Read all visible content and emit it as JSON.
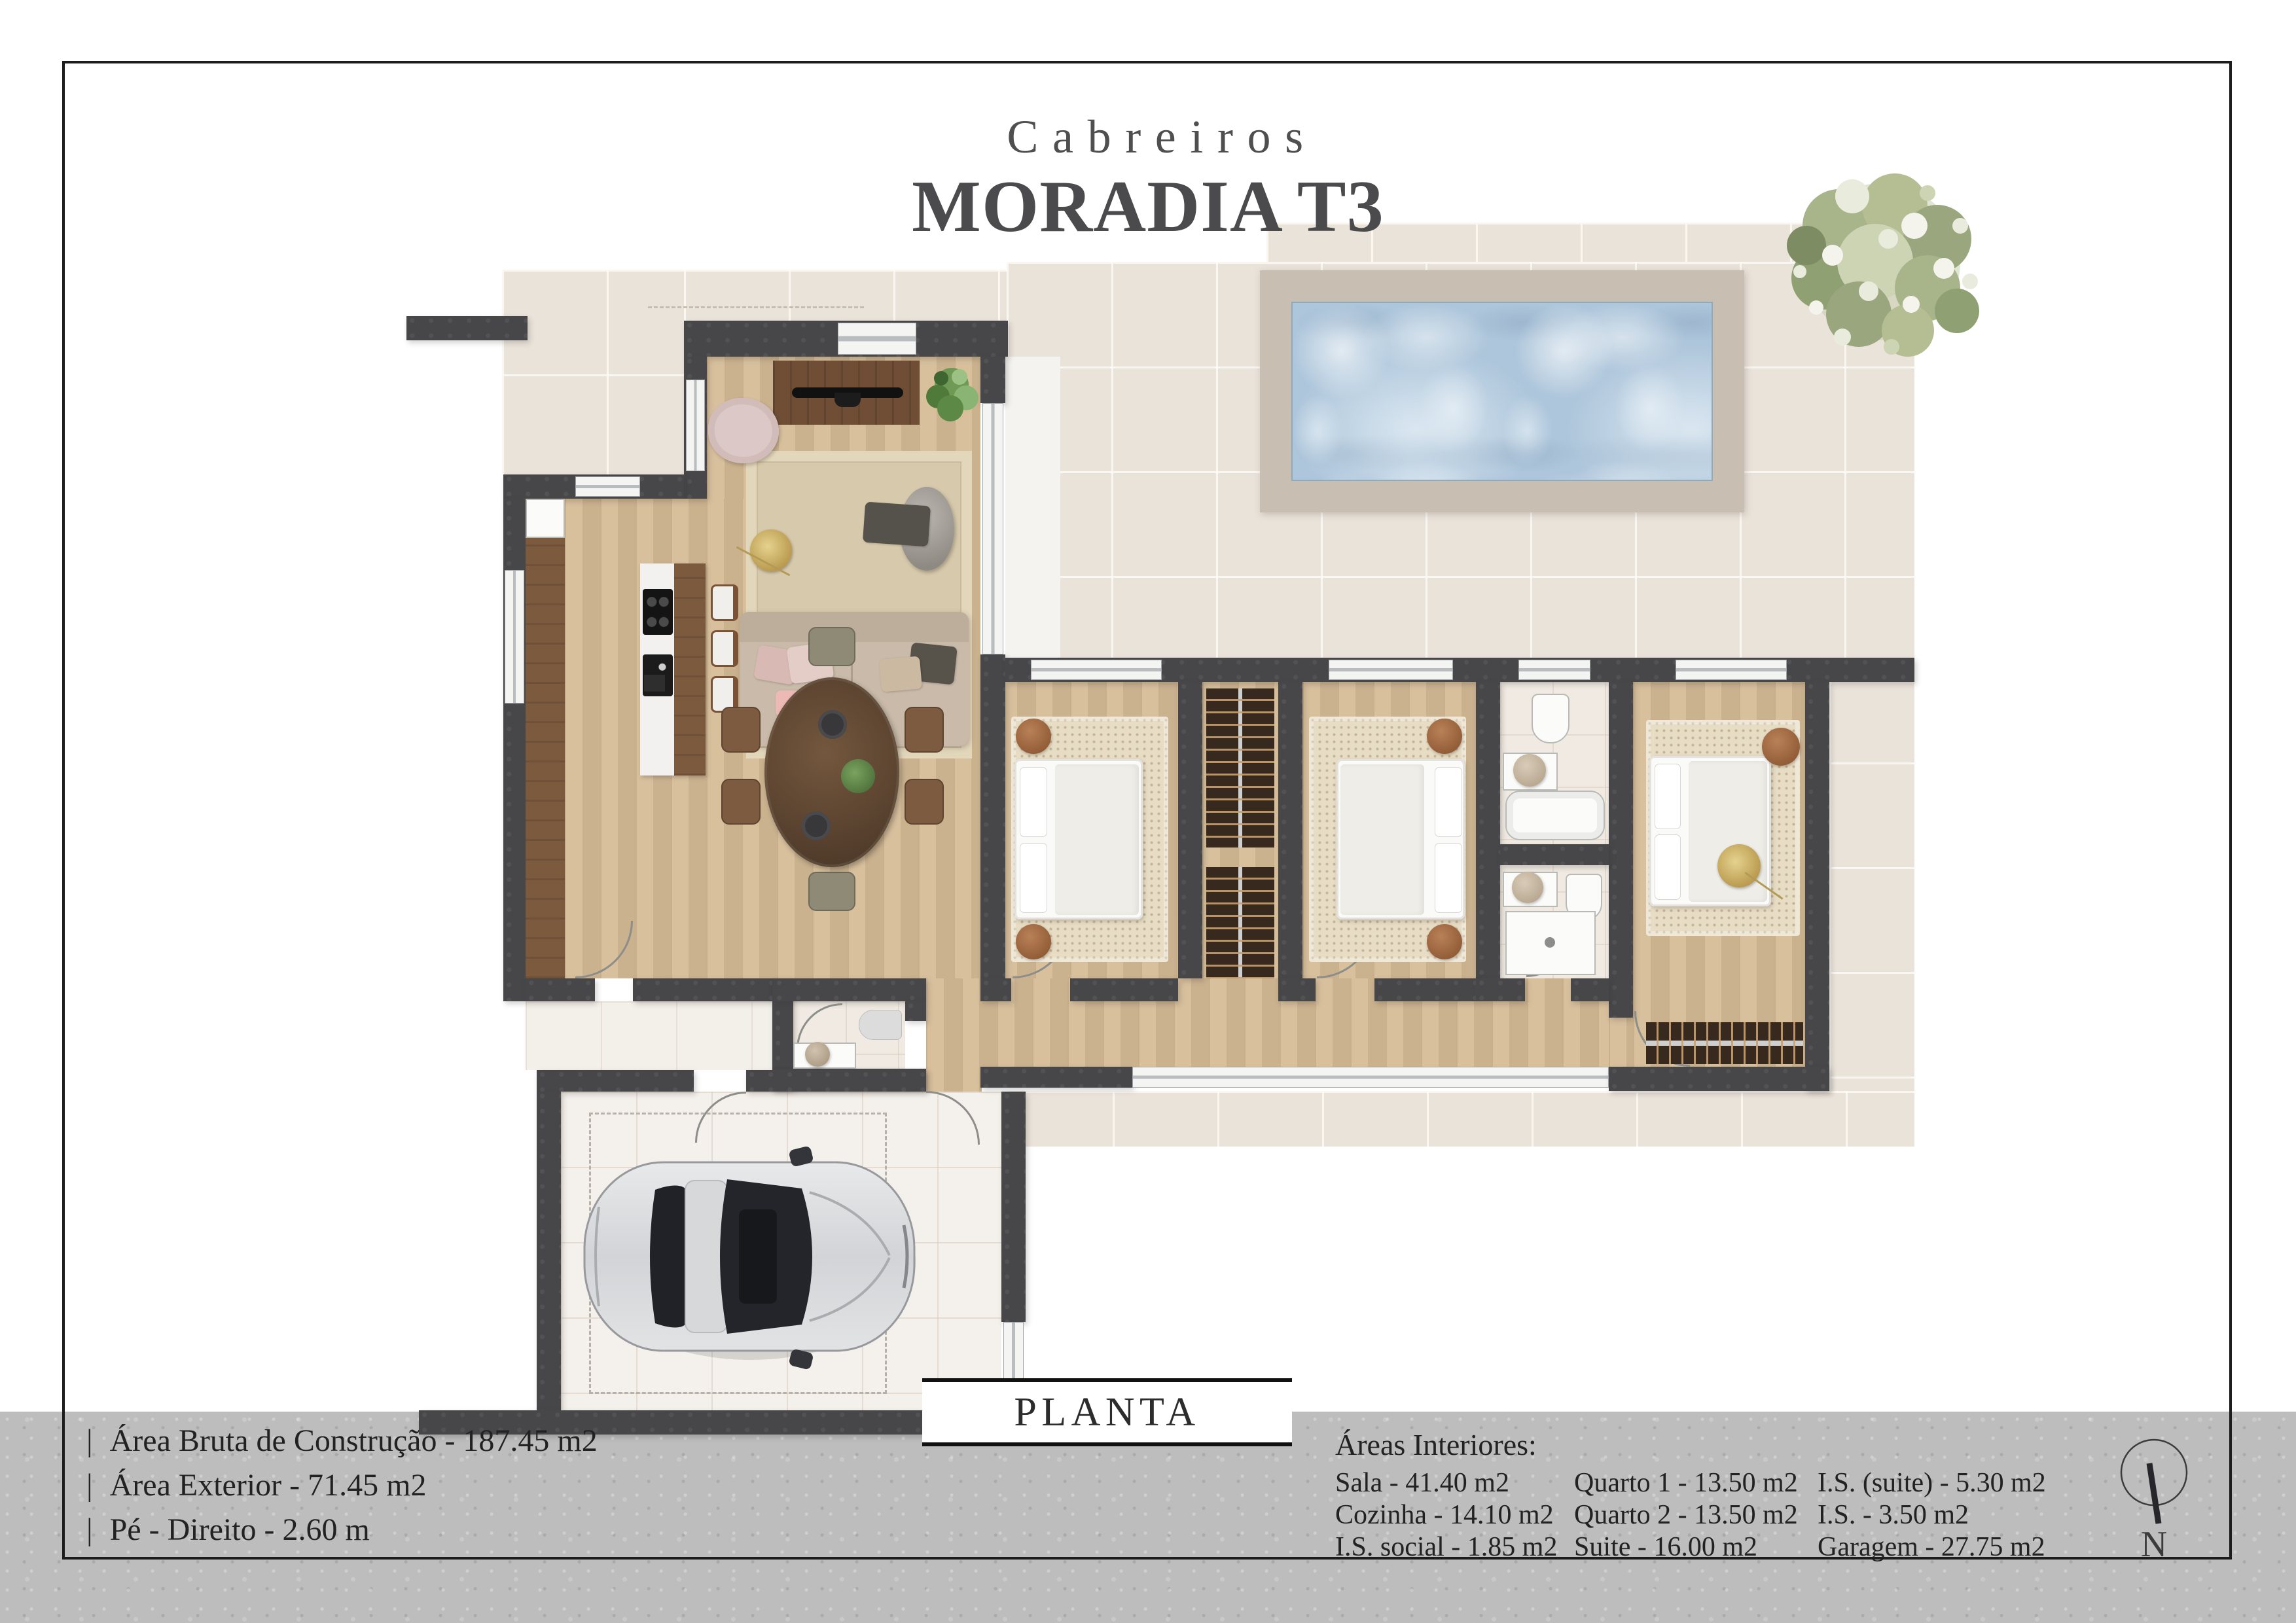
{
  "header": {
    "brand": "Cabreiros",
    "title": "MORADIA T3"
  },
  "plan": {
    "label": "PLANTA",
    "features": [
      "pool",
      "garden-tree",
      "car-in-garage",
      "north-compass"
    ]
  },
  "info_left": {
    "bullet": "|",
    "items": [
      "Área Bruta de Construção - 187.45 m2",
      "Área Exterior - 71.45 m2",
      "Pé - Direito - 2.60 m"
    ]
  },
  "areas": {
    "heading": "Áreas Interiores:",
    "columns": [
      [
        "Sala - 41.40 m2",
        "Cozinha - 14.10 m2",
        "I.S. social - 1.85 m2"
      ],
      [
        "Quarto 1 - 13.50 m2",
        "Quarto 2 - 13.50 m2",
        "Suite - 16.00 m2"
      ],
      [
        "I.S. (suite) - 5.30 m2",
        "I.S. - 3.50 m2",
        "Garagem - 27.75 m2"
      ]
    ]
  },
  "compass": {
    "label": "N"
  },
  "colors": {
    "wall": "#47474a",
    "wood_floor": "#d5bb96",
    "exterior_tile": "#eae3da",
    "pool_water": "#aec6db",
    "pool_deck": "#c8bfb2",
    "footer_band": "#bdbdbd",
    "frame": "#1d1d1d",
    "title_text": "#4b4b4d",
    "dark_wood": "#6f4e35",
    "accent_gold": "#c9ab60",
    "tree_green": "#a8b489"
  }
}
